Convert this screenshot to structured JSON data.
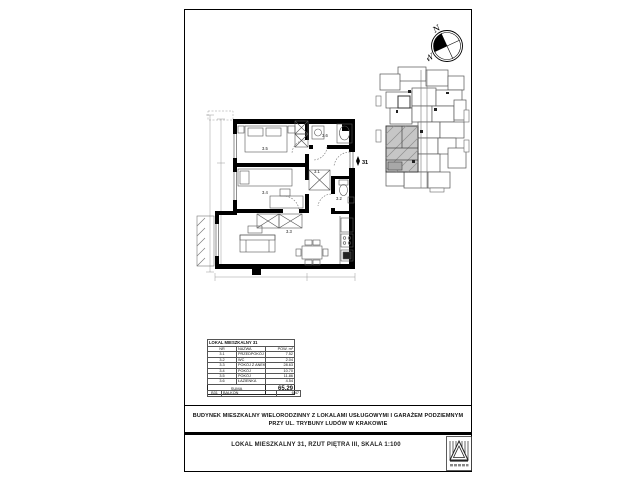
{
  "compass": {
    "north": "N",
    "west": "W"
  },
  "plan": {
    "rooms": {
      "hall": "3.1",
      "wc": "3.2",
      "living": "3.3",
      "room4": "3.4",
      "room5": "3.5",
      "bath": "3.6"
    },
    "unit_marker": "31"
  },
  "area_table": {
    "title": "LOKAL MIESZKALNY 31",
    "columns": {
      "nr": "NR",
      "nazwa": "NAZWA",
      "pow": "POW. m²"
    },
    "rows": [
      {
        "nr": "3.1",
        "nazwa": "PRZEDPOKÓJ",
        "pow": "7.52"
      },
      {
        "nr": "3.2",
        "nazwa": "WC",
        "pow": "2.04"
      },
      {
        "nr": "3.3",
        "nazwa": "POKÓJ Z ANEKSEM KUCH.",
        "pow": "28.63"
      },
      {
        "nr": "3.4",
        "nazwa": "POKÓJ",
        "pow": "10.70"
      },
      {
        "nr": "3.5",
        "nazwa": "POKÓJ",
        "pow": "11.86"
      },
      {
        "nr": "3.6",
        "nazwa": "ŁAZIENKA",
        "pow": "4.54"
      }
    ],
    "suma_label": "SUMA",
    "suma_value": "65.29",
    "balkon_row": {
      "nr": "B31",
      "nazwa": "BALKON",
      "pow": "6.47"
    }
  },
  "title_block": {
    "project_line1": "BUDYNEK MIESZKALNY WIELORODZINNY Z LOKALAMI USŁUGOWYMI I GARAŻEM PODZIEMNYM",
    "project_line2": "PRZY UL. TRYBUNY LUDÓW W KRAKOWIE",
    "drawing_title": "LOKAL MIESZKALNY 31, RZUT PIĘTRA III, SKALA 1:100"
  },
  "colors": {
    "line": "#000000",
    "highlight_unit": "#c6c6c6"
  }
}
